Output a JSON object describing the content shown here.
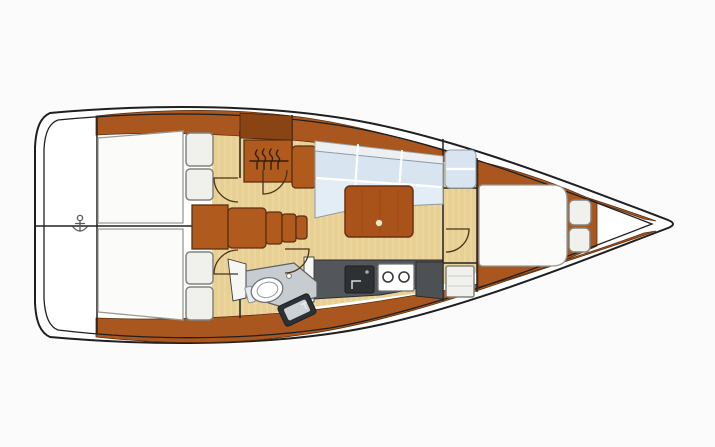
{
  "page": {
    "description": "Top-down interior layout plan of a sailing yacht, bow pointing right",
    "background": "#fbfbfb"
  },
  "palette": {
    "page_bg": "#fbfbfb",
    "hull": "#ffffff",
    "outline": "#1f1f1f",
    "wood": "#a9571f",
    "wood_dark": "#8a4414",
    "wood_box": "#b05a1d",
    "floor": "#e8d095",
    "floor_grain": "#f2e3b2",
    "bed": "#fbfbf9",
    "bed_border": "#9a9a95",
    "locker": "#f0f0ed",
    "locker_border": "#82827e",
    "sofa": "#d8e5f0",
    "sofa_border": "#8e9ca7",
    "table_wood": "#a9531b",
    "table_border": "#6b3110",
    "counter": "#53565a",
    "head_counter": "#c7ccd0",
    "fixture_border": "#6f7479",
    "appliance": "#2e3133",
    "wardrobe": "#4d5154",
    "wall": "#f6f6f4",
    "wall_line": "#222222",
    "door_arc": "#4a3418",
    "symbol": "#33200a",
    "anchor_color": "#5a5a5a"
  },
  "regions": {
    "transom": {
      "label": "Stern transom and swim platform"
    },
    "aft_cabin_port": {
      "label": "Aft cabin port side with double berth and lockers"
    },
    "aft_cabin_starboard": {
      "label": "Aft cabin starboard side with double berth and lockers"
    },
    "companionway": {
      "label": "Companionway with engine box and four steps"
    },
    "saloon": {
      "label": "Saloon with L-shaped settee and folding table"
    },
    "galley": {
      "label": "Galley with sink and two-burner stove"
    },
    "head": {
      "label": "Head compartment with marine toilet and washbasin"
    },
    "forward_cabin": {
      "label": "Forward cabin with V-berth and bow stowage"
    },
    "bow": {
      "label": "Bow forepeak anchor locker"
    }
  },
  "fixtures": {
    "anchor_symbol": {
      "label": "Rudder / datum symbol on transom"
    },
    "instrument_icon": {
      "label": "Companionway instrument panel icon"
    },
    "steps": {
      "label": "Companionway steps",
      "count": 4
    },
    "aft_lockers": {
      "label": "Aft cabin locker doors",
      "count": 4
    },
    "saloon_table": {
      "label": "Saloon table with latch dot"
    },
    "galley_sink": {
      "label": "Galley sink with faucet"
    },
    "stove": {
      "label": "Two-burner stove",
      "burners": 2
    },
    "toilet": {
      "label": "Marine toilet"
    },
    "washbasin": {
      "label": "Angled washbasin"
    },
    "wardrobe": {
      "label": "Hanging wardrobe"
    },
    "shelf_locker": {
      "label": "Shelved locker"
    },
    "bow_cushions": {
      "label": "Bow stowage cushions",
      "count": 2
    },
    "doors": {
      "label": "Door swing arcs",
      "count": 5
    }
  }
}
